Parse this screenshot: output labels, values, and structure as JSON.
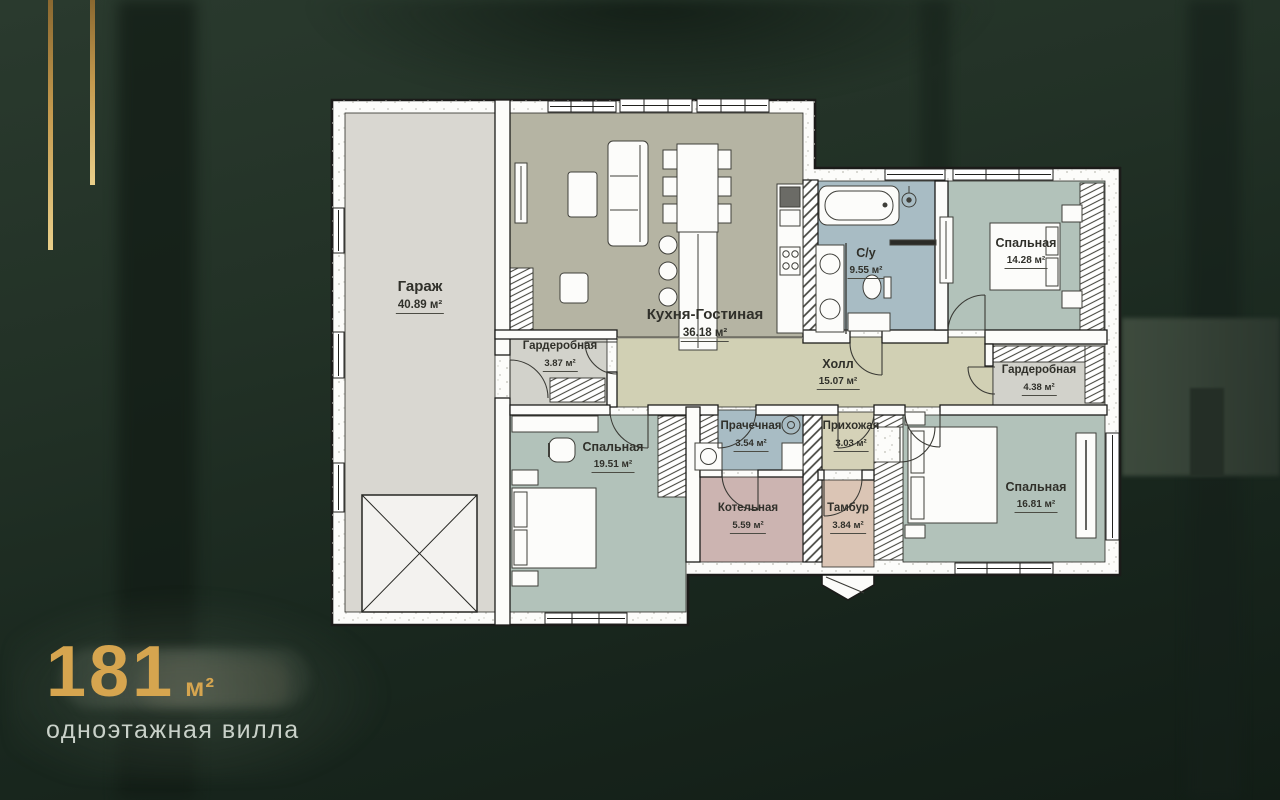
{
  "badge": {
    "area_value": "181",
    "area_unit": "м²",
    "subtitle": "одноэтажная вилла"
  },
  "plan": {
    "rooms": [
      {
        "id": "garage",
        "name": "Гараж",
        "area": "40.89 м²",
        "color": "#d9d7d1"
      },
      {
        "id": "kitchen",
        "name": "Кухня-Гостиная",
        "area": "36.18 м²",
        "color": "#b5b4a3"
      },
      {
        "id": "bathroom",
        "name": "С/у",
        "area": "9.55 м²",
        "color": "#a8bcc4"
      },
      {
        "id": "bedroom1",
        "name": "Спальная",
        "area": "14.28 м²",
        "color": "#b2c2ba"
      },
      {
        "id": "hall",
        "name": "Холл",
        "area": "15.07 м²",
        "color": "#d1d0b4"
      },
      {
        "id": "wardrobe1",
        "name": "Гардеробная",
        "area": "3.87 м²",
        "color": "#d2d2cb"
      },
      {
        "id": "wardrobe2",
        "name": "Гардеробная",
        "area": "4.38 м²",
        "color": "#d2d2cb"
      },
      {
        "id": "bedroom2",
        "name": "Спальная",
        "area": "19.51 м²",
        "color": "#b2c2ba"
      },
      {
        "id": "laundry",
        "name": "Прачечная",
        "area": "3.54 м²",
        "color": "#a8bcc4"
      },
      {
        "id": "boiler",
        "name": "Котельная",
        "area": "5.59 м²",
        "color": "#ccb4b1"
      },
      {
        "id": "entry",
        "name": "Прихожая",
        "area": "3.03 м²",
        "color": "#d5d2b8"
      },
      {
        "id": "tambour",
        "name": "Тамбур",
        "area": "3.84 м²",
        "color": "#dbc5b5"
      },
      {
        "id": "bedroom3",
        "name": "Спальная",
        "area": "16.81 м²",
        "color": "#b2c2ba"
      }
    ]
  },
  "colors": {
    "accent_gold": "#d6a54f",
    "subtitle_text": "#c9d1c9",
    "background_dark_green": "#1d2b21",
    "wall_white": "#fcfcfa",
    "outline_black": "#1b1b19"
  }
}
